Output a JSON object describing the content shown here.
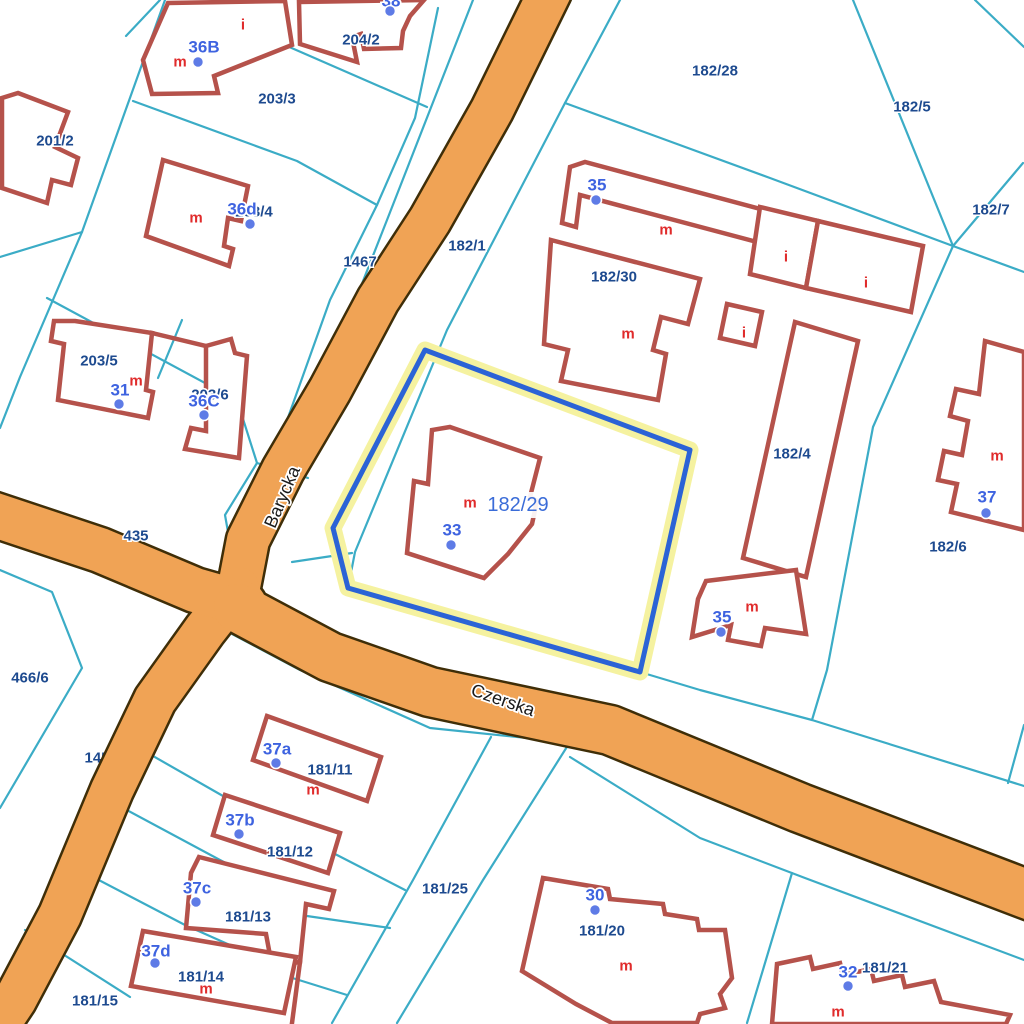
{
  "map": {
    "streets": [
      "Barycka",
      "Czerska"
    ],
    "highlighted_parcel": "182/29",
    "parcels": [
      "204/2",
      "203/3",
      "201/2",
      "203/4",
      "182/28",
      "182/5",
      "182/7",
      "1467",
      "182/1",
      "20",
      "145",
      "182/30",
      "203/5",
      "203/6",
      "435",
      "182/4",
      "182/6",
      "466/6",
      "181/11",
      "181/12",
      "181/25",
      "181/13",
      "181/14",
      "181/15",
      "181/20",
      "181/21"
    ],
    "addresses": [
      "36B",
      "38",
      "36d",
      "31",
      "36C",
      "35",
      "33",
      "35",
      "37",
      "37a",
      "37b",
      "37c",
      "37d",
      "30",
      "32"
    ],
    "use_labels": [
      "i",
      "m",
      "m",
      "m",
      "m",
      "i",
      "i",
      "m",
      "i",
      "m",
      "m",
      "m",
      "m",
      "m",
      "m",
      "m"
    ],
    "colors": {
      "background": "#FFFFFF",
      "road_fill": "#F0A355",
      "road_casing": "#3F2E08",
      "parcel_line": "#3BACC6",
      "building_outline": "#B5524B",
      "parcel_text": "#1D4A8F",
      "address_text": "#3E63E0",
      "address_dot": "#5E7BE6",
      "use_text": "#E02B2B",
      "street_text": "#1A1A1A",
      "highlight_stroke": "#2B63D6",
      "highlight_halo": "#F5F2A0"
    }
  }
}
